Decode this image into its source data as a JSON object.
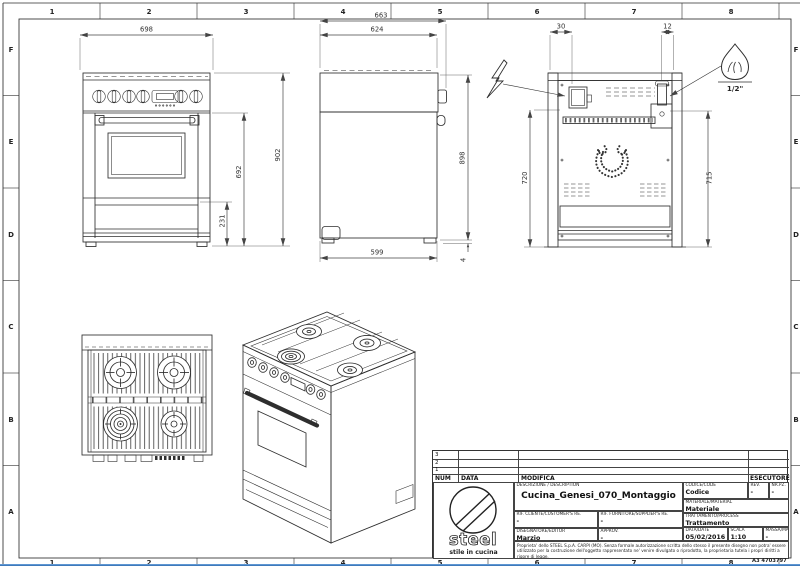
{
  "border": {
    "columns": [
      "1",
      "2",
      "3",
      "4",
      "5",
      "6",
      "7",
      "8"
    ],
    "rows": [
      "F",
      "E",
      "D",
      "C",
      "B",
      "A"
    ],
    "sheet_code": "A3 4703797"
  },
  "views": {
    "front": {
      "width": "698",
      "door_height": "692",
      "plinth_height": "231",
      "overall_height": "902"
    },
    "side": {
      "depth_overall": "663",
      "depth_top": "624",
      "height_right": "898",
      "depth_base": "599",
      "foot_height": "4"
    },
    "rear": {
      "offset_left": "30",
      "offset_right": "12",
      "height_left": "720",
      "height_right": "715",
      "gas_connection": "1/2\""
    }
  },
  "symbols": {
    "electric": "lightning-bolt",
    "gas": "flame"
  },
  "title_block": {
    "revision_rows": [
      "3",
      "2",
      "1"
    ],
    "revision_headers": {
      "num": "NUM",
      "data": "DATA",
      "modifica": "MODIFICA",
      "esecutore": "ESECUTORE"
    },
    "logo": {
      "brand": "steel",
      "tagline": "stile in cucina"
    },
    "description_label": "DESCRIZIONE / DESCRIPTION",
    "description": "Cucina_Genesi_070_Montaggio",
    "codice_label": "CODICE/CODE",
    "codice": "Codice",
    "rev_label": "REV.",
    "rev": "-",
    "nrpz_label": "NR.PZ.",
    "nrpz": "-",
    "materiale_label": "MATERIALE/MATERIAL",
    "materiale": "Materiale",
    "rif_cliente_label": "RIF. CLIENTE/CUSTOMER'S RE.",
    "rif_cliente": "-",
    "rif_fornitore_label": "RIF. FORNITORE/SUPPLIER'S RE.",
    "rif_fornitore": "-",
    "trattamento_label": "TRATTAMENTO/PROCESS",
    "trattamento": "Trattamento",
    "disegnatore_label": "DISEGNATORE/EDITOR",
    "disegnatore": "Marzio",
    "approv_label": "APPROV.",
    "approv": "-",
    "data_label": "DATA/DATE",
    "data": "05/02/2016",
    "scala_label": "SCALA",
    "scala": "1:10",
    "massa_label": "MASSA/MASS kg",
    "massa": "-",
    "legal": "Proprieta' dello STEEL S.p.A. CARPI (MO). Senza formale autorizzazione scritta dello stesso il presente disegno non potra' essere utilizzato per la costruzione dell'oggetto rappresentato ne' venire divulgato o riprodotto, la proprietaria tutela i propri diritti a rigore di legge."
  }
}
